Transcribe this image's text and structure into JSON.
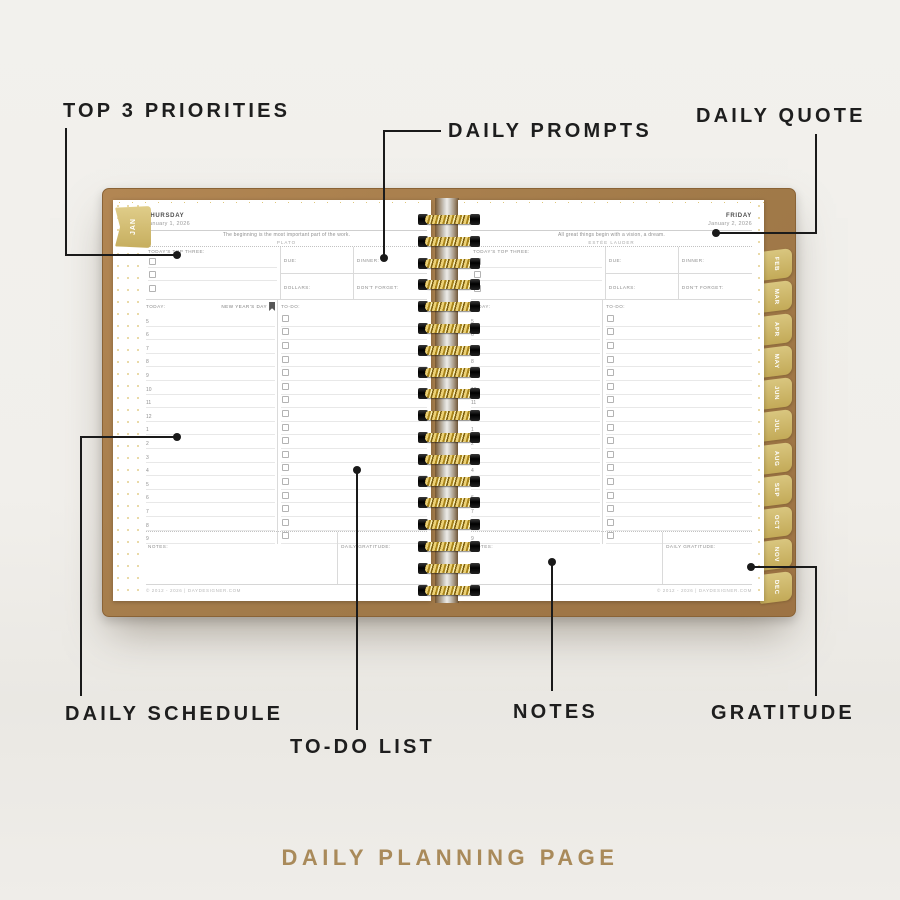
{
  "caption": "DAILY PLANNING PAGE",
  "annotations": {
    "top_three": "TOP 3 PRIORITIES",
    "daily_prompts": "DAILY PROMPTS",
    "daily_quote": "DAILY QUOTE",
    "daily_schedule": "DAILY SCHEDULE",
    "todo_list": "TO-DO LIST",
    "notes": "NOTES",
    "gratitude": "GRATITUDE"
  },
  "tabs": {
    "current": "JAN",
    "months": [
      "FEB",
      "MAR",
      "APR",
      "MAY",
      "JUN",
      "JUL",
      "AUG",
      "SEP",
      "OCT",
      "NOV",
      "DEC"
    ]
  },
  "labels": {
    "top_three": "TODAY'S TOP THREE:",
    "due": "DUE:",
    "dinner": "DINNER:",
    "dollars": "DOLLARS:",
    "dont_forget": "DON'T FORGET:",
    "today": "TODAY:",
    "todo": "TO-DO:",
    "notes": "NOTES:",
    "gratitude": "DAILY GRATITUDE:"
  },
  "schedule_times": [
    "5",
    "6",
    "7",
    "8",
    "9",
    "10",
    "11",
    "12",
    "1",
    "2",
    "3",
    "4",
    "5",
    "6",
    "7",
    "8",
    "9"
  ],
  "pages": {
    "left": {
      "day": "THURSDAY",
      "date": "January 1, 2026",
      "quote": "The beginning is the most important part of the work.",
      "quote_author": "PLATO",
      "holiday": "NEW YEAR'S DAY",
      "footer": "© 2012 - 2026 | DAYDESIGNER.COM"
    },
    "right": {
      "day": "FRIDAY",
      "date": "January 2, 2026",
      "quote": "All great things begin with a vision, a dream.",
      "quote_author": "ESTÉE LAUDER",
      "footer": "© 2012 - 2026 | DAYDESIGNER.COM"
    }
  },
  "colors": {
    "cover_brown": "#a87e4e",
    "tab_gold": "#cdb469",
    "spiral_gold": "#d4af37",
    "caption_gold": "#a98a5a",
    "annotation_black": "#1e1e1e"
  }
}
